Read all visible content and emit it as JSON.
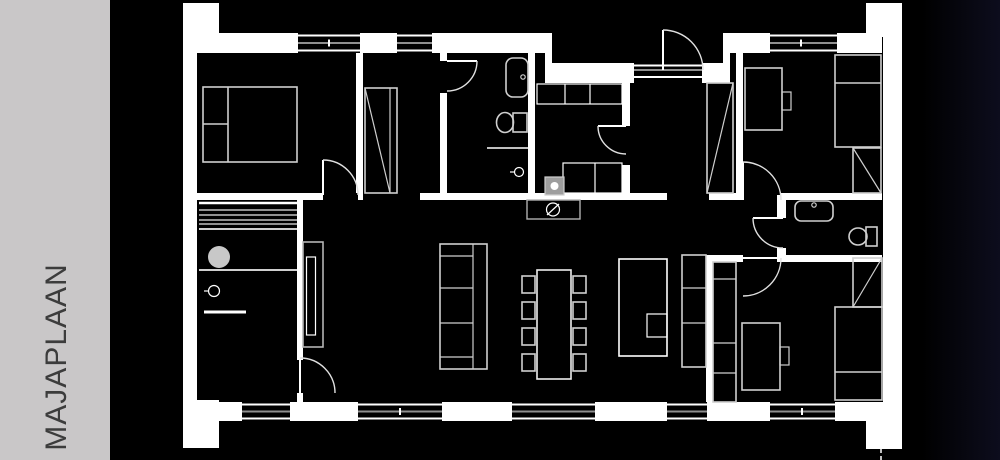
{
  "sidebar": {
    "title": "MAJAPLAAN"
  },
  "colors": {
    "background": "#000000",
    "sidebar_bg": "#c9c7c8",
    "sidebar_text": "#3c3c3c",
    "wall_lines": "#ffffff",
    "furniture_lines": "#cfcfcf",
    "window_mullion": "#8f8f8f",
    "sauna_heater_fill": "#c8c8c8",
    "right_edge_tint": "#0d0d1d"
  },
  "plan": {
    "type": "floor-plan",
    "rooms": [
      {
        "name": "bedroom-1",
        "elements": [
          "double-bed",
          "wardrobe",
          "swing-door"
        ]
      },
      {
        "name": "bathroom-1",
        "elements": [
          "bathtub",
          "toilet",
          "shower-drain",
          "shower-partition",
          "swing-door"
        ]
      },
      {
        "name": "utility-wc",
        "elements": [
          "wall-cabinets",
          "base-cabinets",
          "washing-machine",
          "swing-door"
        ]
      },
      {
        "name": "entry-vestibule",
        "elements": [
          "entrance-door",
          "threshold",
          "closet-diagonal"
        ]
      },
      {
        "name": "bedroom-2",
        "elements": [
          "desk",
          "desk-chair",
          "single-bed",
          "corner-wardrobe",
          "swing-door"
        ]
      },
      {
        "name": "bathroom-2",
        "elements": [
          "bathtub",
          "toilet",
          "swing-door"
        ]
      },
      {
        "name": "hall",
        "elements": [
          "swing-door"
        ]
      },
      {
        "name": "bedroom-3",
        "elements": [
          "closet-column",
          "desk",
          "desk-chair",
          "corner-wardrobe",
          "single-bed",
          "swing-door"
        ]
      },
      {
        "name": "sauna-shower",
        "elements": [
          "sauna-benches",
          "sauna-heater",
          "floor-drain",
          "partition-wall",
          "swing-door"
        ]
      },
      {
        "name": "living-dining-kitchen",
        "elements": [
          "sofa",
          "fireplace",
          "dining-table",
          "eight-chairs",
          "kitchen-island",
          "island-sink",
          "kitchen-counter",
          "cooktop-appliance"
        ]
      }
    ],
    "window_count": {
      "north_facade": 3,
      "entry_sidelight": 1,
      "south_facade": 5
    }
  }
}
